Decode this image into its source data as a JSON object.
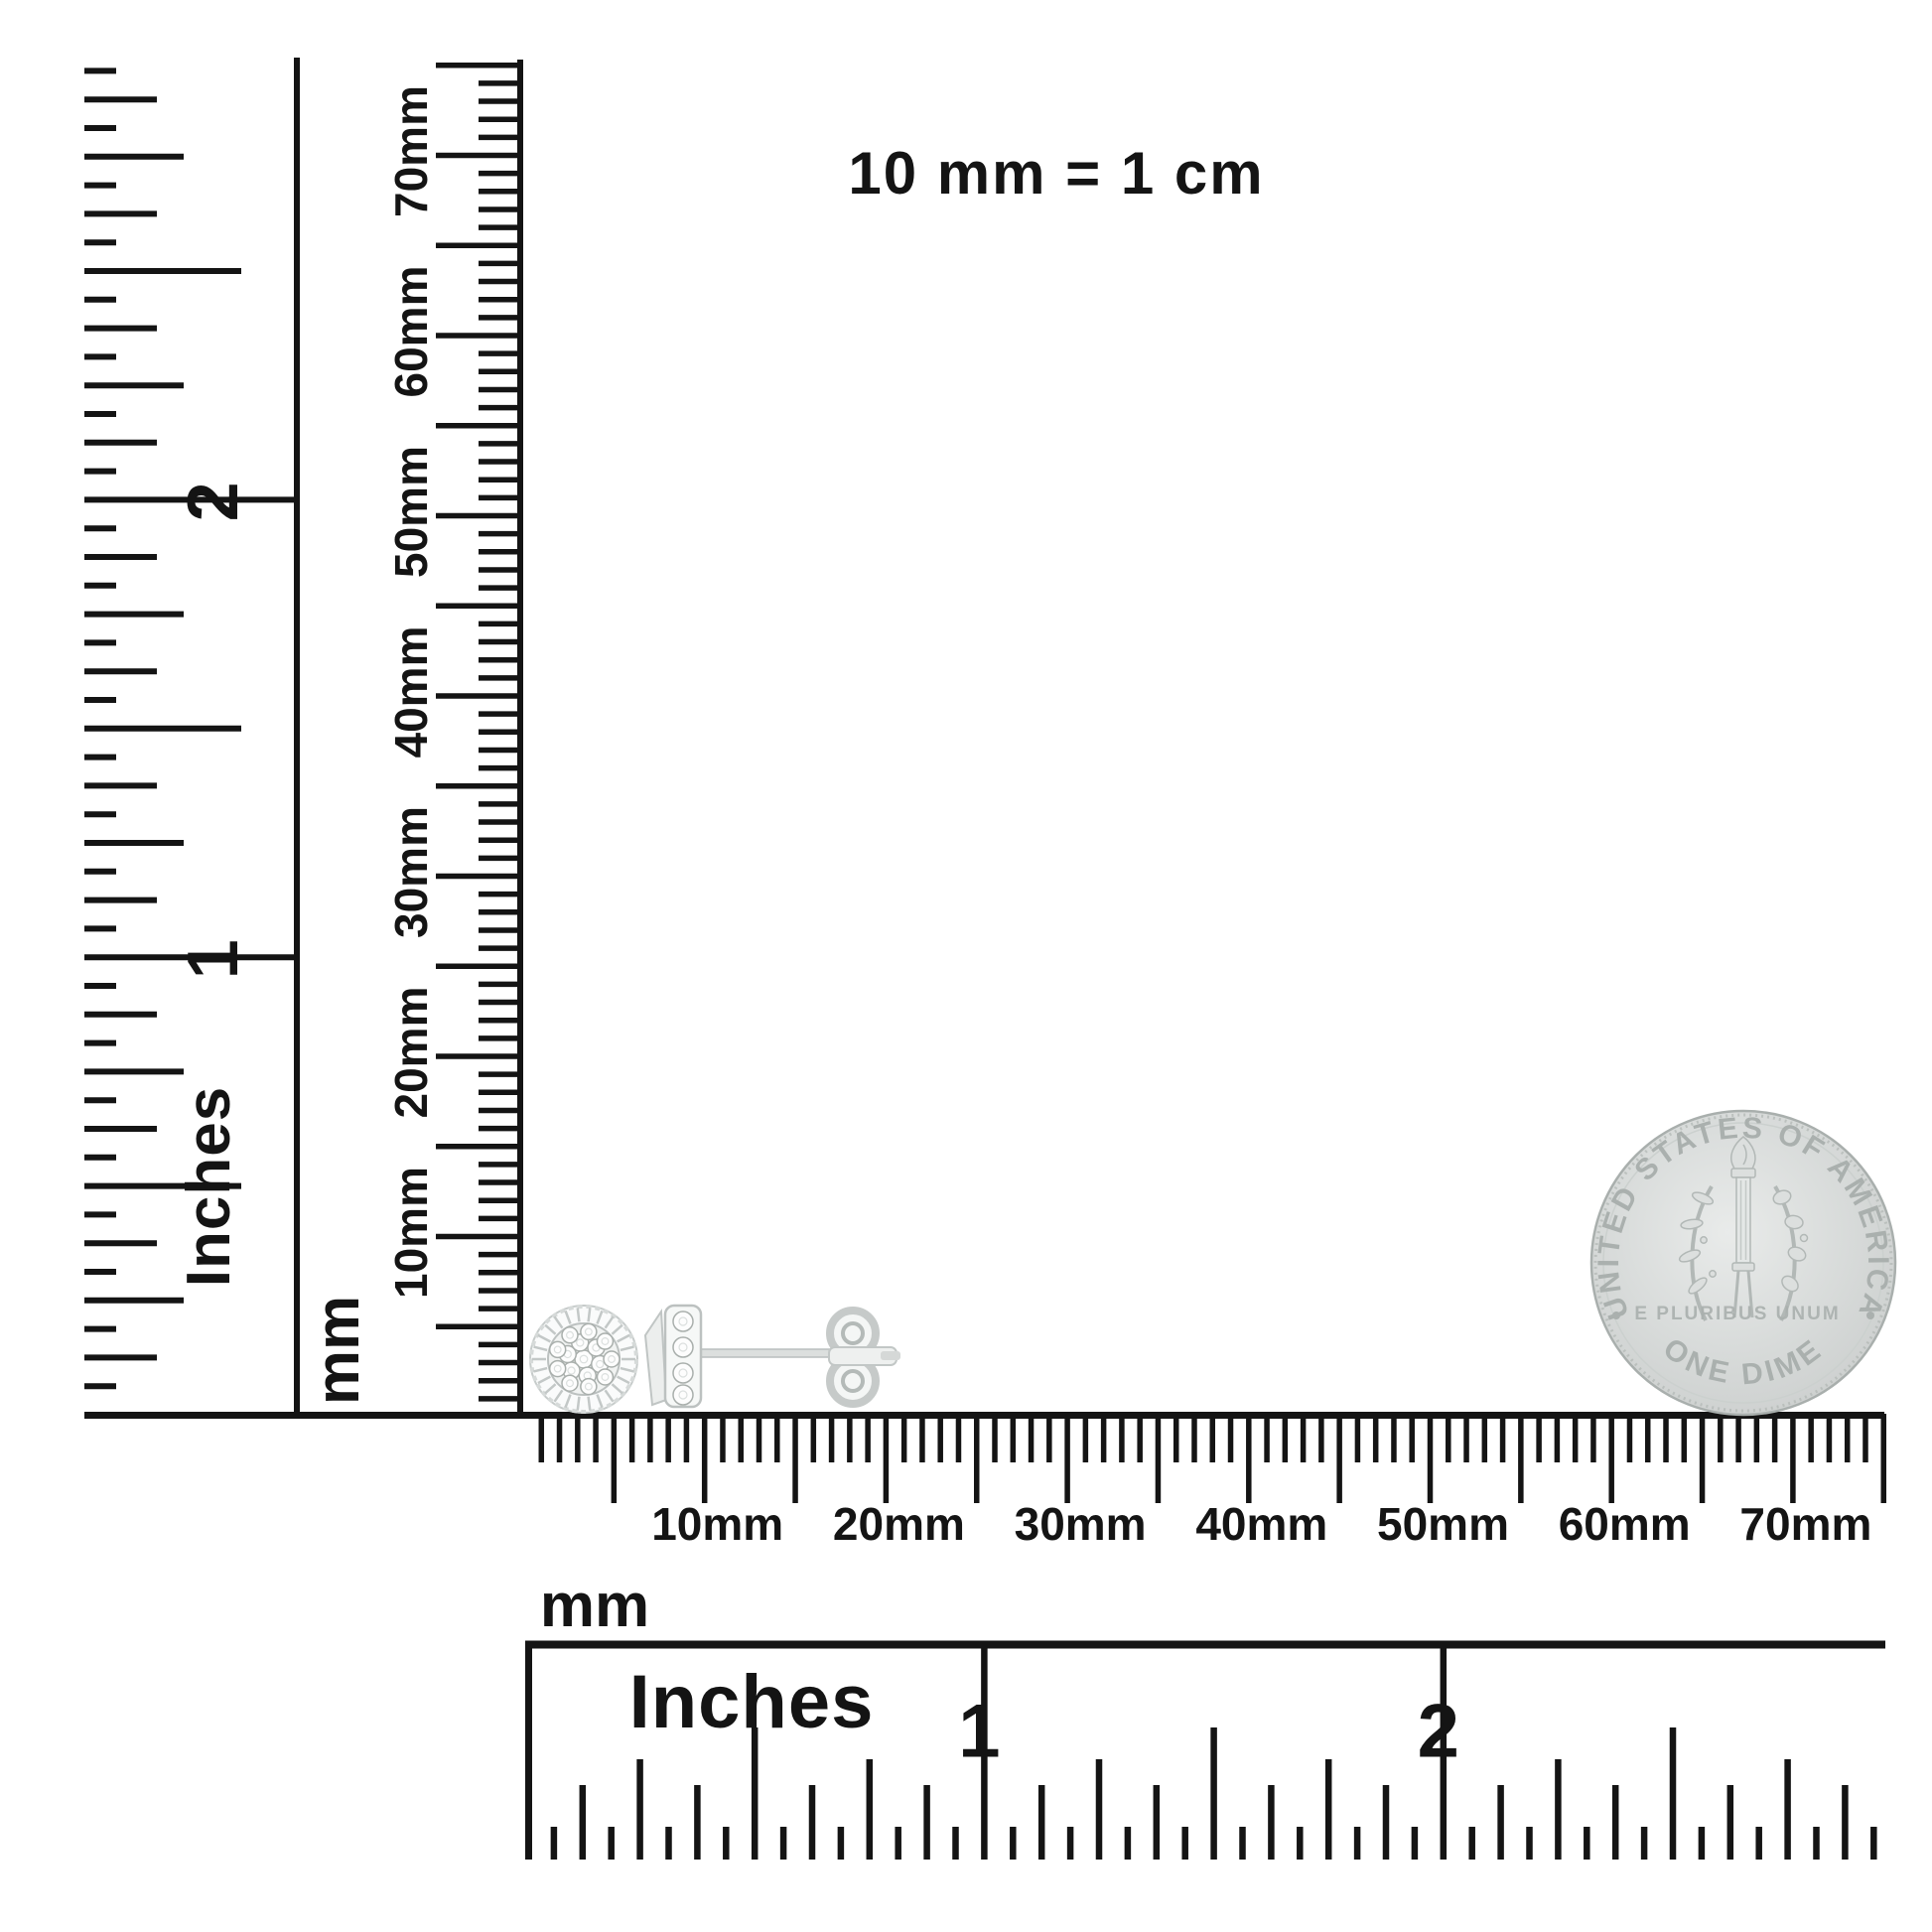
{
  "scale_note": "10 mm = 1 cm",
  "rulers": {
    "left_inches": {
      "unit": "Inches",
      "labels": [
        "1",
        "2"
      ]
    },
    "left_mm": {
      "unit": "mm",
      "labels": [
        "10mm",
        "20mm",
        "30mm",
        "40mm",
        "50mm",
        "60mm",
        "70mm"
      ]
    },
    "bottom_mm": {
      "unit": "mm",
      "labels": [
        "10mm",
        "20mm",
        "30mm",
        "40mm",
        "50mm",
        "60mm",
        "70mm"
      ]
    },
    "bottom_inches": {
      "unit": "Inches",
      "labels": [
        "1",
        "2"
      ]
    }
  },
  "coin": {
    "top_legend": "UNITED STATES OF AMERICA",
    "motto": "E PLURIBUS UNUM",
    "denomination": "ONE DIME"
  },
  "colors": {
    "ink": "#141414",
    "coin_face": "#d8dbda",
    "coin_detail": "#b2b8b6",
    "metal_light": "#f6f8f7",
    "metal_mid": "#c9cecd",
    "stone_edge": "#a9afac"
  }
}
